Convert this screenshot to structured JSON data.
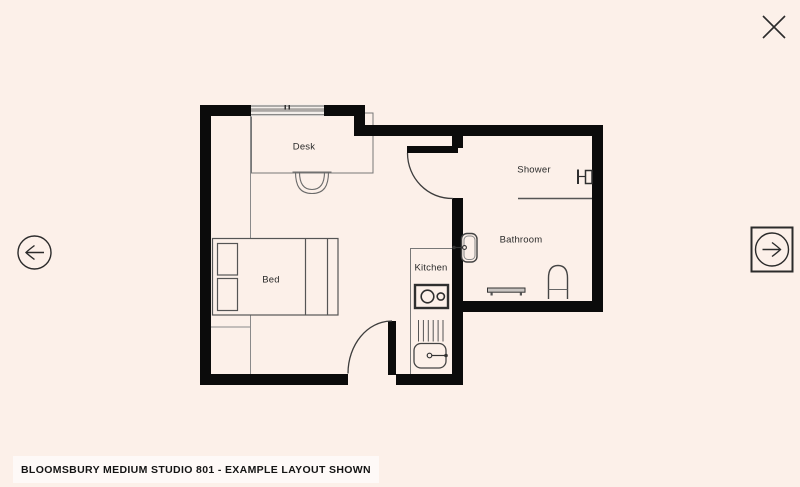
{
  "viewer": {
    "caption": "BLOOMSBURY MEDIUM STUDIO 801 - EXAMPLE LAYOUT SHOWN",
    "icons": {
      "close": "close-icon",
      "prev": "arrow-left-icon",
      "next": "arrow-right-icon"
    }
  },
  "colors": {
    "background": "#FCF0E9",
    "walls": "#0B0B0B",
    "thin_lines": "#6E6E6E",
    "caption_background": "#F3EDE8",
    "caption_text": "#141414"
  },
  "floorplan": {
    "rooms": [
      {
        "id": "desk",
        "label": "Desk"
      },
      {
        "id": "bed",
        "label": "Bed"
      },
      {
        "id": "kitchen",
        "label": "Kitchen"
      },
      {
        "id": "shower",
        "label": "Shower"
      },
      {
        "id": "bathroom",
        "label": "Bathroom"
      }
    ]
  }
}
